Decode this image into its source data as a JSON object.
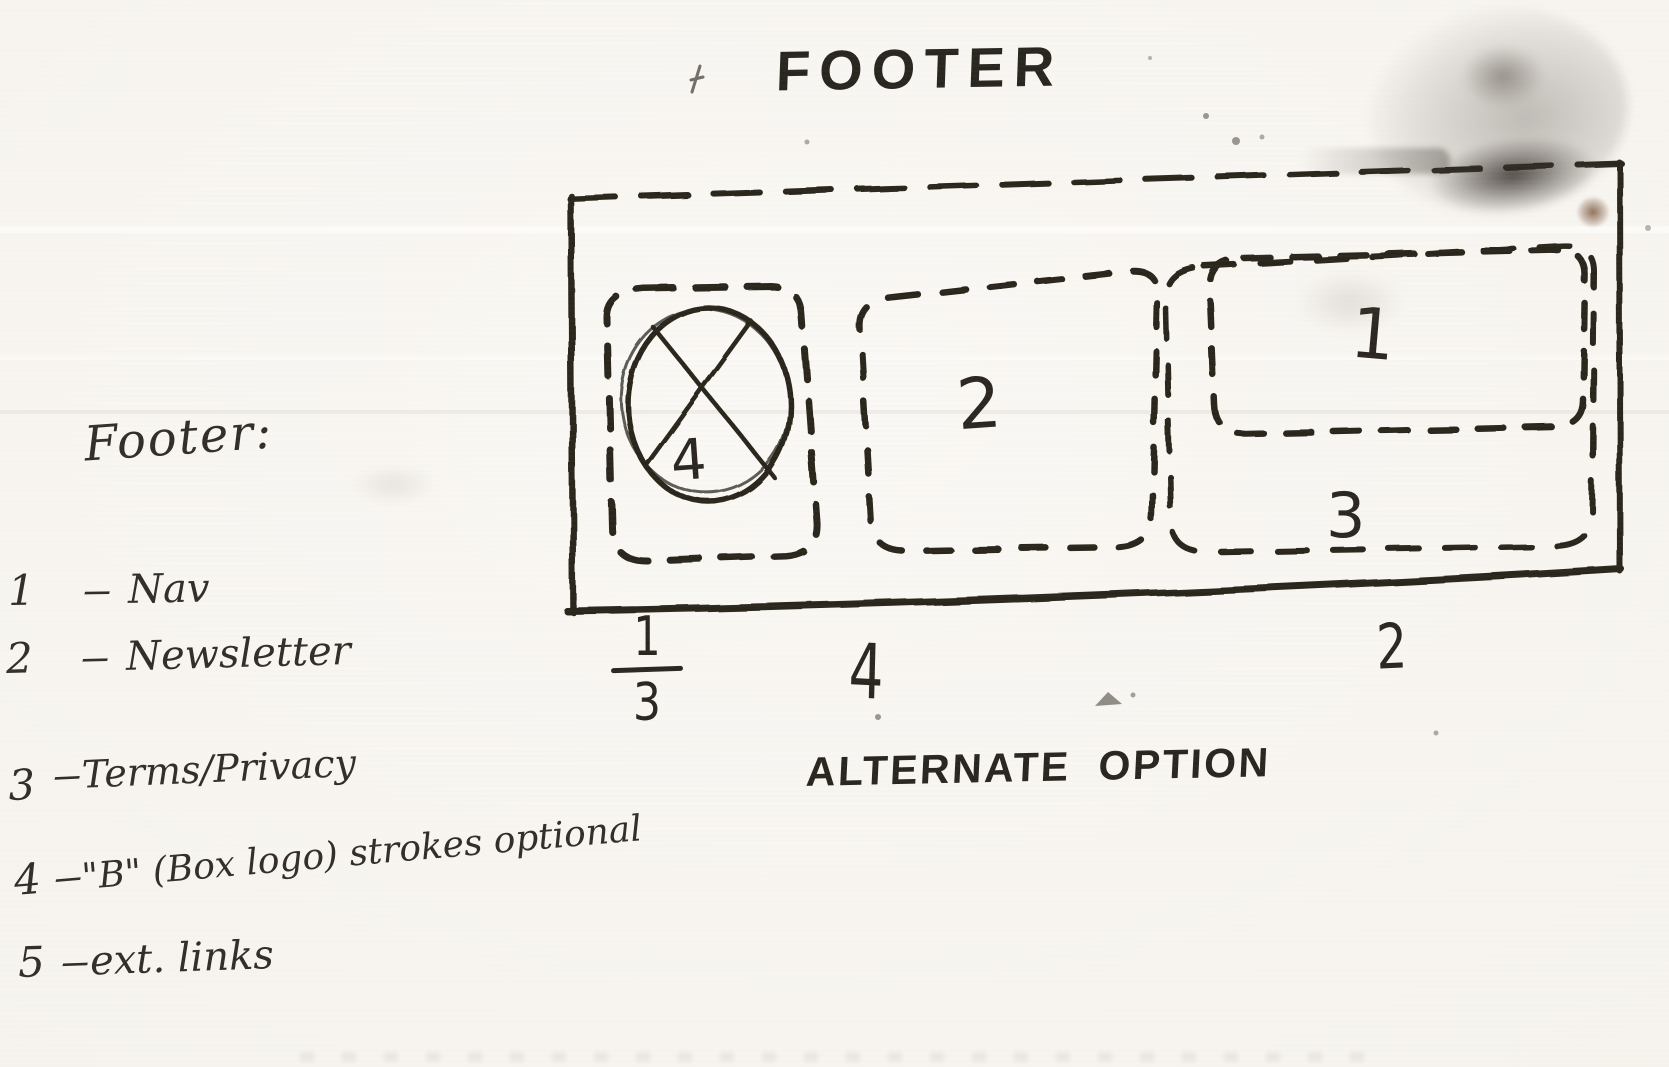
{
  "title": "FOOTER",
  "caption": "ALTERNATE OPTION",
  "diagram": {
    "zones": {
      "logo": "4",
      "newsletter": "2",
      "nav": "1",
      "terms": "3"
    },
    "widths": {
      "left_numerator": "1",
      "left_denominator": "3",
      "middle": "4",
      "right": "2"
    }
  },
  "legend": {
    "heading": "Footer:",
    "separator": "–",
    "items": [
      {
        "num": "1",
        "label": "Nav"
      },
      {
        "num": "2",
        "label": "Newsletter"
      },
      {
        "num": "3",
        "label": "Terms/Privacy"
      },
      {
        "num": "4",
        "label": "\"B\" (Box logo) strokes optional"
      },
      {
        "num": "5",
        "label": "ext. links"
      }
    ]
  },
  "colors": {
    "paper": "#f7f5f1",
    "ink": "#2b2720",
    "handwriting": "#322d26",
    "stain": "#4a433c",
    "stain_spot": "#7d5a42"
  }
}
